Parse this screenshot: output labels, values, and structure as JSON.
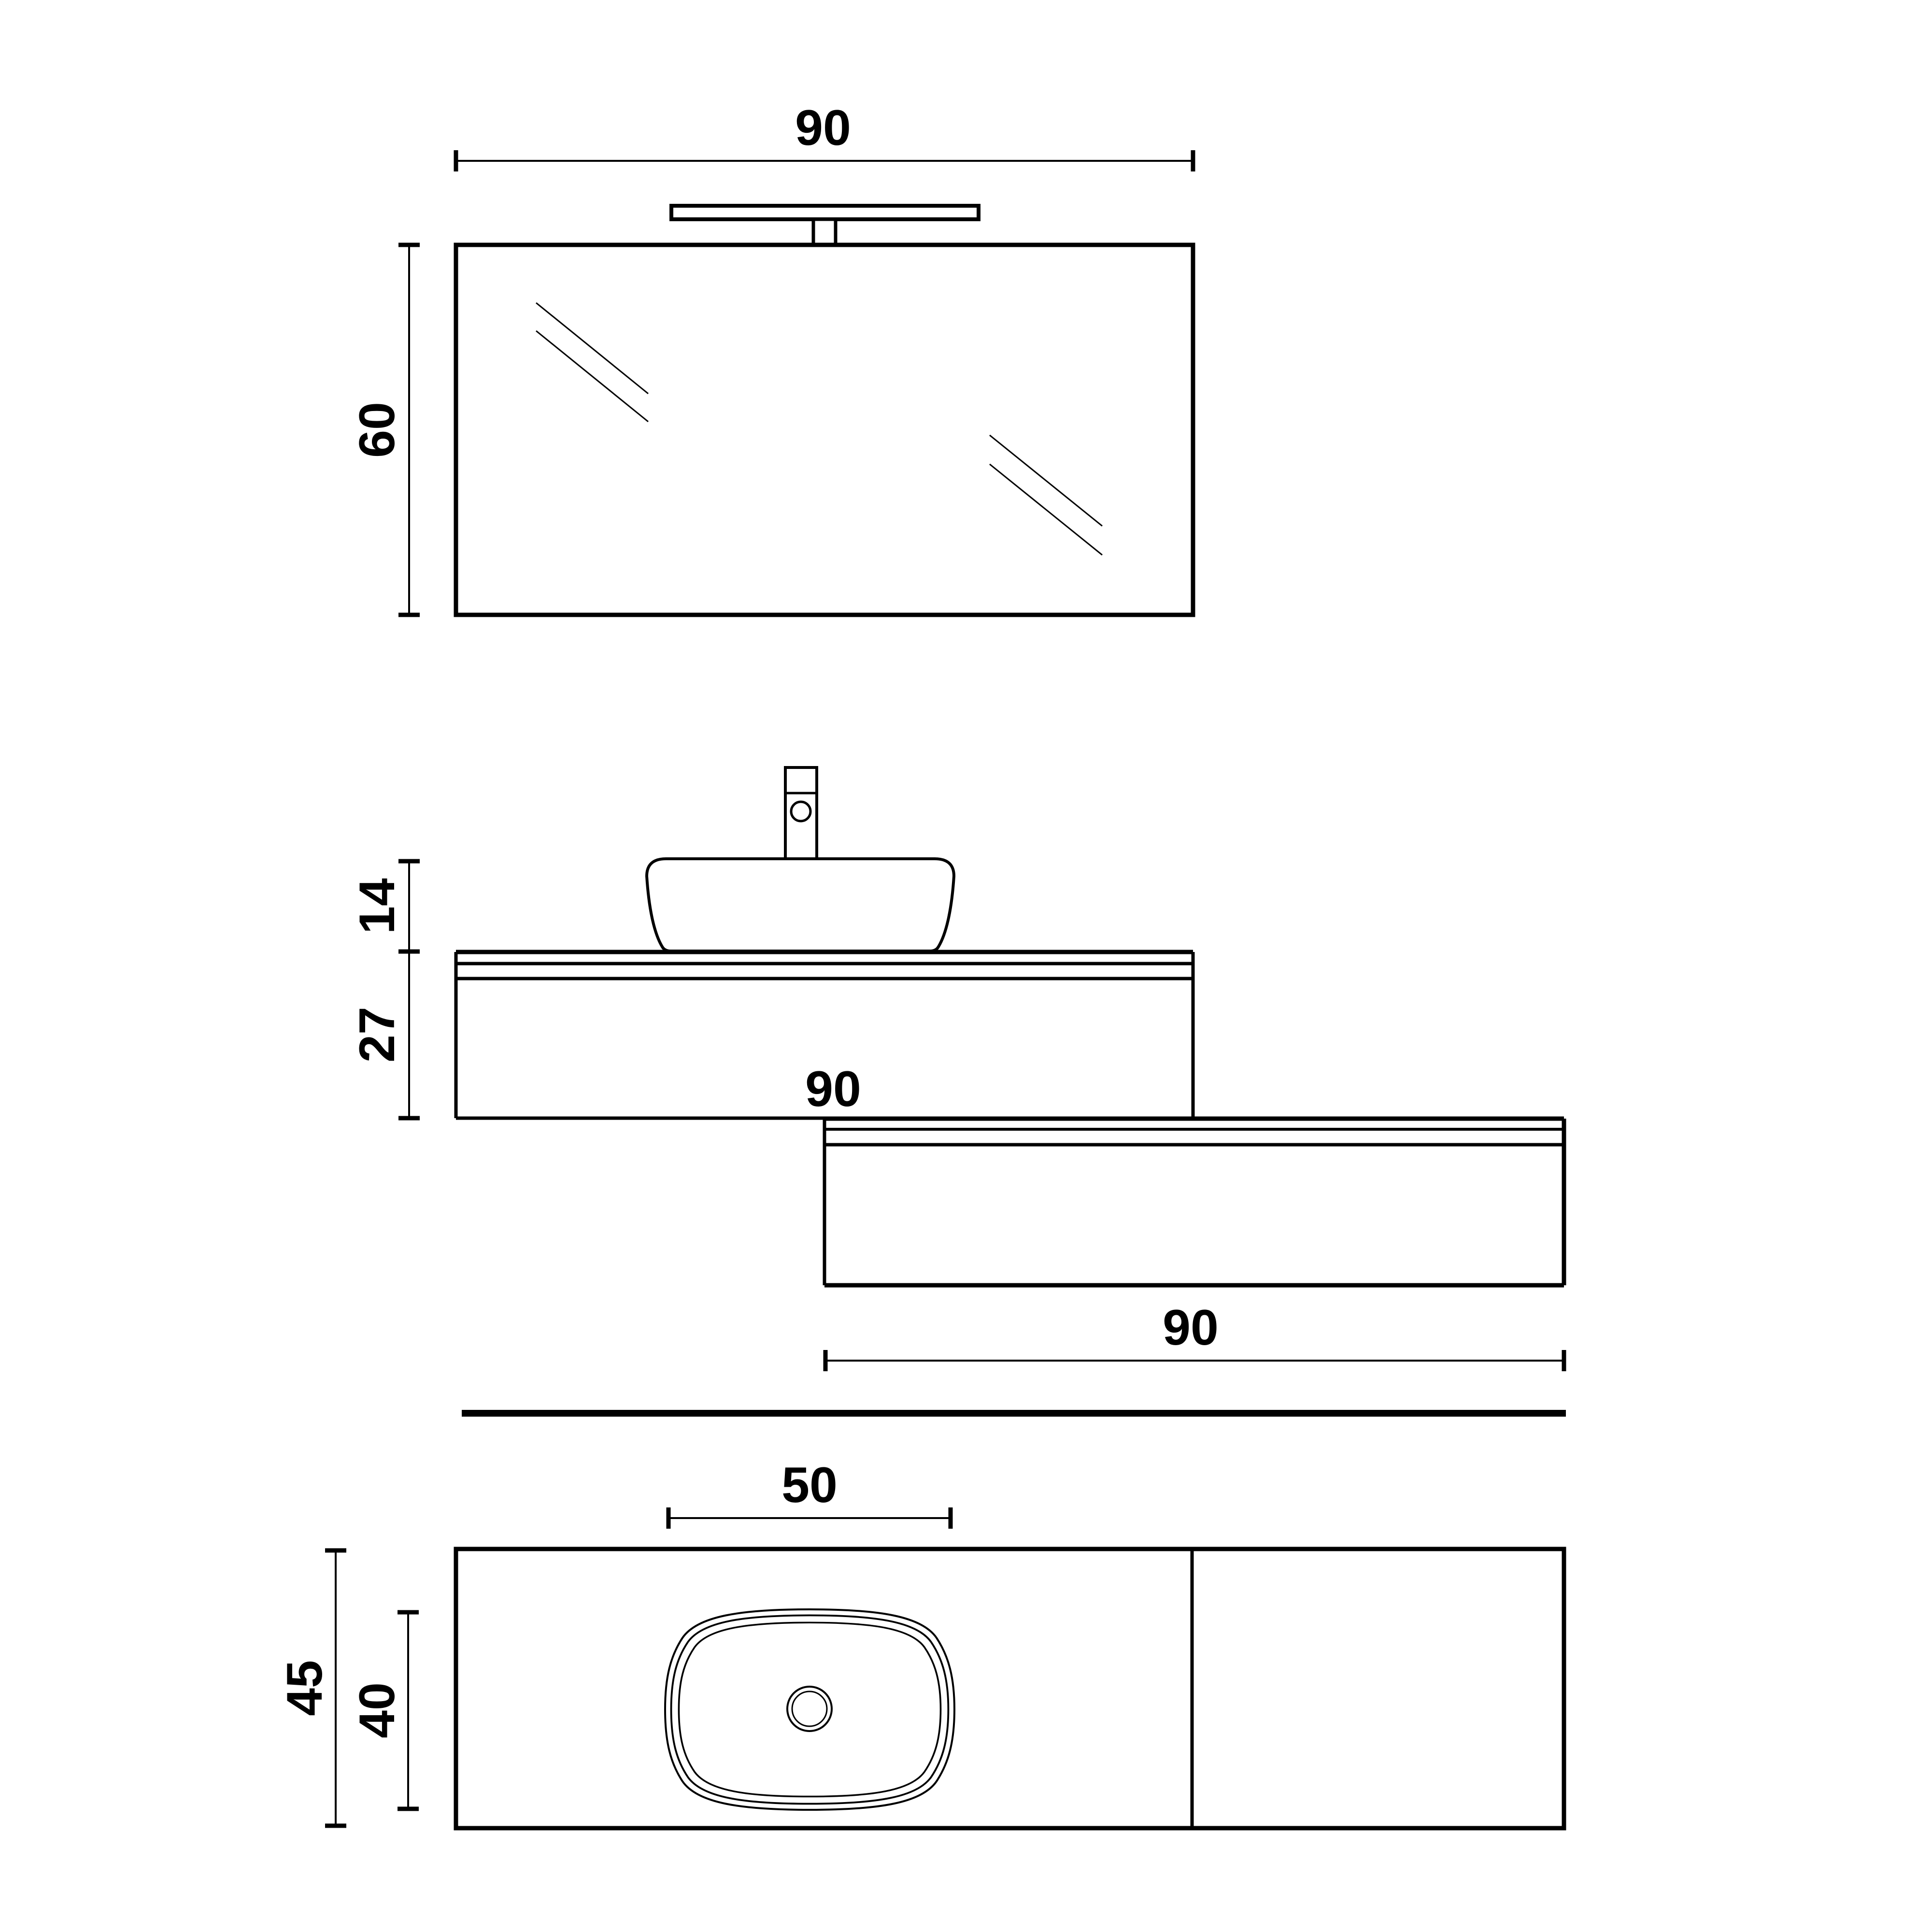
{
  "drawing": {
    "type": "bathroom-vanity-technical-drawing",
    "colors": {
      "ink": "#000000",
      "paper": "#ffffff"
    },
    "mirror_view": {
      "width_label": "90",
      "height_label": "60"
    },
    "elevation_view": {
      "basin_height_label": "14",
      "cabinet_height_label": "27",
      "right_unit_tag_label": "90",
      "right_unit_width_label": "90"
    },
    "plan_view": {
      "basin_width_label": "50",
      "total_depth_label": "45",
      "basin_depth_label": "40"
    }
  }
}
